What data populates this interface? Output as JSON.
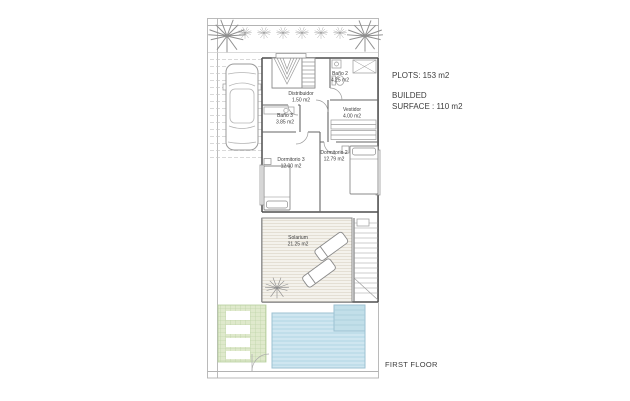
{
  "colors": {
    "pool": "#cfe6f0",
    "pool-stripe": "#b2d5e3",
    "pool-step": "#c2dfe9",
    "pool-border": "#9cc2d2",
    "grass": "#dfe9cc",
    "grass-line": "#b6cf9d",
    "hatch-bg": "#f4f2ec",
    "hatch-line": "#ddd7ca",
    "wall": "#4f4f4f",
    "line": "#9a9a9a",
    "boundary": "#b3b3b3",
    "text": "#3c3c3c"
  },
  "plan": {
    "rooms": [
      {
        "name": "Baño 2",
        "area": "4.25 m2"
      },
      {
        "name": "Distribuidor",
        "area": "1.50 m2"
      },
      {
        "name": "Baño 3",
        "area": "3.85 m2"
      },
      {
        "name": "Vestidor",
        "area": "4.00 m2"
      },
      {
        "name": "Dormitorio 3",
        "area": "12.00 m2"
      },
      {
        "name": "Dormitorio 2",
        "area": "12.79 m2"
      },
      {
        "name": "Solarium",
        "area": "21.25 m2"
      }
    ]
  },
  "annotations": {
    "plots": "PLOTS: 153 m2",
    "builded_line1": "BUILDED",
    "builded_line2": "SURFACE : 110 m2",
    "floor_label": "FIRST FLOOR"
  }
}
